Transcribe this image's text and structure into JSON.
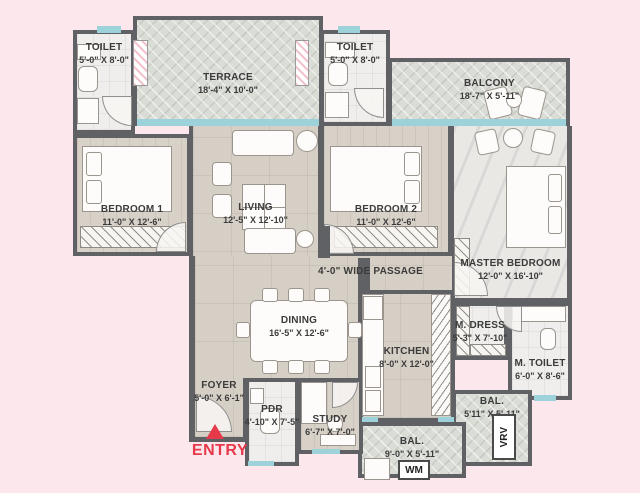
{
  "palette": {
    "bg": "#fbe7ec",
    "wall": "#5f6164",
    "window": "#9ed2da",
    "accent": "#e6394a",
    "ink": "#3b3b3b"
  },
  "rooms": {
    "toilet1": {
      "name": "TOILET",
      "dims": "5'-0\" X 8'-0\""
    },
    "terrace": {
      "name": "TERRACE",
      "dims": "18'-4\" X 10'-0\""
    },
    "toilet2": {
      "name": "TOILET",
      "dims": "5'-0\" X 8'-0\""
    },
    "balcony": {
      "name": "BALCONY",
      "dims": "18'-7\" X 5'-11\""
    },
    "bedroom1": {
      "name": "BEDROOM 1",
      "dims": "11'-0\" X 12'-6\""
    },
    "living": {
      "name": "LIVING",
      "dims": "12'-5\" X 12'-10\""
    },
    "bedroom2": {
      "name": "BEDROOM 2",
      "dims": "11'-0\" X 12'-6\""
    },
    "master_bedroom": {
      "name": "MASTER BEDROOM",
      "dims": "12'-0\" X 16'-10\""
    },
    "passage": {
      "name": "4'-0\" WIDE PASSAGE"
    },
    "dining": {
      "name": "DINING",
      "dims": "16'-5\" X 12'-6\""
    },
    "kitchen": {
      "name": "KITCHEN",
      "dims": "8'-0\" X 12'-0\""
    },
    "m_dress": {
      "name": "M. DRESS",
      "dims": "5'-3\" X 7'-10\""
    },
    "m_toilet": {
      "name": "M. TOILET",
      "dims": "6'-0\" X 8'-6\""
    },
    "bal_right": {
      "name": "BAL.",
      "dims": "5'11\" X 5'-11\""
    },
    "bal_bottom": {
      "name": "BAL.",
      "dims": "9'-0\" X 5'-11\""
    },
    "foyer": {
      "name": "FOYER",
      "dims": "5'-0\" X 6'-1\""
    },
    "pdr": {
      "name": "PDR",
      "dims": "4'-10\" X 7'-5\""
    },
    "study": {
      "name": "STUDY",
      "dims": "6'-7\" X 7'-0\""
    }
  },
  "labels": {
    "entry": "ENTRY",
    "wm": "WM",
    "vrv": "VRV"
  }
}
